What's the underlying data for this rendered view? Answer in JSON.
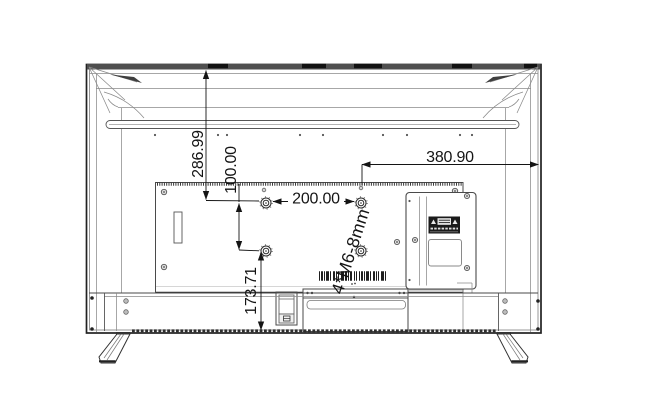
{
  "drawing": {
    "subject": "TV rear view wall-mount dimension drawing",
    "units": "mm",
    "background_color": "#ffffff",
    "line_color": "#2b2b2b",
    "label_plate_color": "#1a1a1a",
    "dimensions": {
      "top_to_vesa": "286.99",
      "vesa_vertical_pitch": "100.00",
      "vesa_horizontal_pitch": "200.00",
      "vesa_to_right_edge": "380.90",
      "vesa_to_bottom": "173.71",
      "screw_spec": "4*M6-8mm"
    },
    "features": {
      "vesa_holes": 4,
      "icons": [
        "warning-triangle-icon",
        "barcode",
        "rating-label",
        "power-inlet",
        "stand-foot"
      ]
    }
  }
}
